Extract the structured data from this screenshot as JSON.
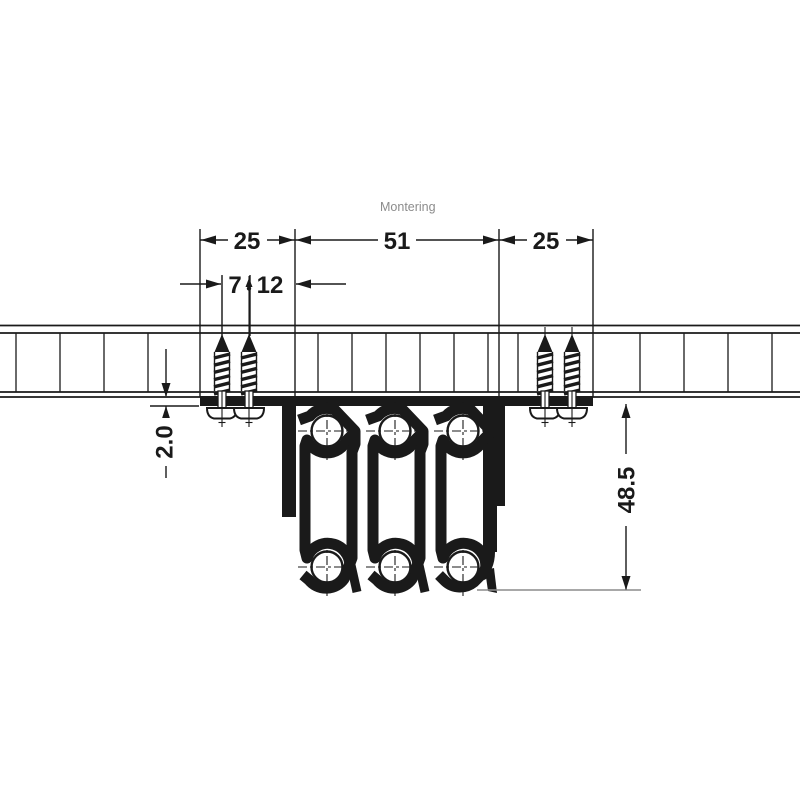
{
  "title": "Montering",
  "dims": {
    "w25_left": "25",
    "w51": "51",
    "w25_right": "25",
    "w7": "7",
    "w12": "12",
    "flange_thickness": "2.0",
    "slide_height": "48.5"
  },
  "colors": {
    "line": "#1a1a1a",
    "caption_gray": "#8c8c8c",
    "background": "#ffffff"
  }
}
